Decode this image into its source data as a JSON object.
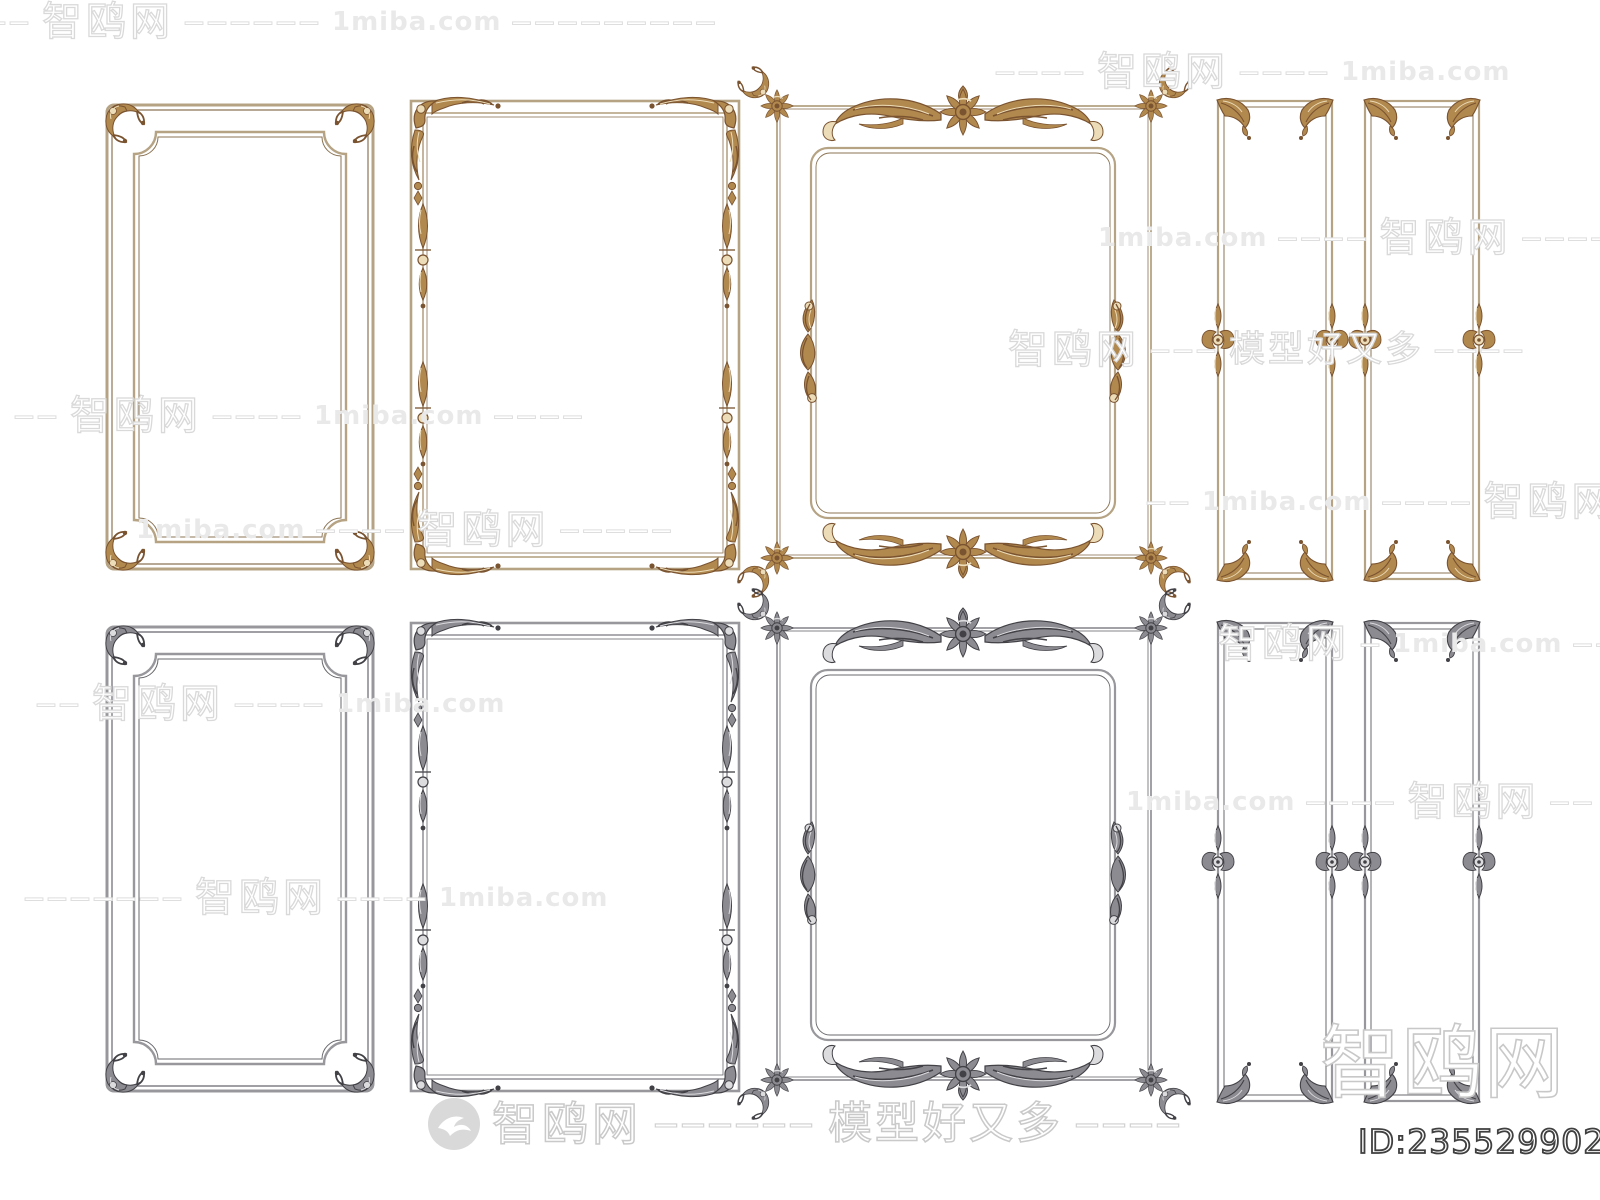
{
  "meta": {
    "site_name": "智鸥网",
    "site_domain": "1miba.com",
    "site_slogan": "模型好又多",
    "product_id": "ID:235529902"
  },
  "colors": {
    "background": "#ffffff",
    "gold_rail": "#b5a384",
    "gold_ornament_dark": "#7a5330",
    "gold_ornament_light": "#ecdcb8",
    "silver_rail": "#98989c",
    "silver_ornament_dark": "#414146",
    "silver_ornament_light": "#dcdcdf",
    "watermark_outline": "#d9d9d9",
    "id_outline": "#404040"
  },
  "frames": {
    "top_row_finish": "gold",
    "bottom_row_finish": "silver",
    "types": [
      "simple-panel-frame-with-corner-sprigs",
      "ornate-corner-moulding-frame",
      "cartouche-scroll-frame",
      "narrow-panel-frame-pair-with-palmettes"
    ]
  },
  "watermarks": {
    "rows": [
      {
        "x": -14,
        "y": 2,
        "parts": [
          [
            "dash",
            "——"
          ],
          [
            "zh",
            "智鸥网"
          ],
          [
            "dash",
            "——————"
          ],
          [
            "miba",
            "1miba.com"
          ],
          [
            "dash",
            "—————————"
          ]
        ]
      },
      {
        "x": 995,
        "y": 52,
        "parts": [
          [
            "dash",
            "————"
          ],
          [
            "zh",
            "智鸥网"
          ],
          [
            "dash",
            "————"
          ],
          [
            "miba",
            "1miba.com"
          ]
        ]
      },
      {
        "x": 1098,
        "y": 218,
        "parts": [
          [
            "miba",
            "1miba.com"
          ],
          [
            "dash",
            "————"
          ],
          [
            "zh",
            "智鸥网"
          ],
          [
            "dash",
            "—————"
          ]
        ]
      },
      {
        "x": 1008,
        "y": 330,
        "parts": [
          [
            "zh",
            "智鸥网"
          ],
          [
            "dash",
            "———"
          ],
          [
            "mx",
            "模型好又多"
          ],
          [
            "dash",
            "————"
          ]
        ]
      },
      {
        "x": 14,
        "y": 396,
        "parts": [
          [
            "dash",
            "——"
          ],
          [
            "zh",
            "智鸥网"
          ],
          [
            "dash",
            "————"
          ],
          [
            "miba",
            "1miba.com"
          ],
          [
            "dash",
            "————"
          ]
        ]
      },
      {
        "x": 1146,
        "y": 482,
        "parts": [
          [
            "dash",
            "——"
          ],
          [
            "miba",
            "1miba.com"
          ],
          [
            "dash",
            "————"
          ],
          [
            "zh",
            "智鸥网"
          ]
        ]
      },
      {
        "x": 136,
        "y": 510,
        "parts": [
          [
            "miba",
            "1miba.com"
          ],
          [
            "dash",
            "————"
          ],
          [
            "zh",
            "智鸥网"
          ],
          [
            "dash",
            "—————"
          ]
        ]
      },
      {
        "x": 1218,
        "y": 624,
        "parts": [
          [
            "zh",
            "智鸥网"
          ],
          [
            "dash",
            "—"
          ],
          [
            "miba",
            "1miba.com"
          ],
          [
            "dash",
            "———"
          ]
        ]
      },
      {
        "x": 36,
        "y": 684,
        "parts": [
          [
            "dash",
            "——"
          ],
          [
            "zh",
            "智鸥网"
          ],
          [
            "dash",
            "————"
          ],
          [
            "miba",
            "1miba.com"
          ]
        ]
      },
      {
        "x": 1126,
        "y": 782,
        "parts": [
          [
            "miba",
            "1miba.com"
          ],
          [
            "dash",
            "————"
          ],
          [
            "zh",
            "智鸥网"
          ],
          [
            "dash",
            "——"
          ]
        ]
      },
      {
        "x": 24,
        "y": 878,
        "parts": [
          [
            "dash",
            "———————"
          ],
          [
            "zh",
            "智鸥网"
          ],
          [
            "dash",
            "————"
          ],
          [
            "miba",
            "1miba.com"
          ]
        ]
      }
    ],
    "footer_row": {
      "brand": "智鸥网",
      "dash1": "——————",
      "slogan": "模型好又多",
      "dash2": "————"
    },
    "giant": {
      "text": "智鸥网"
    }
  },
  "id_badge": {
    "text": "ID:235529902"
  }
}
